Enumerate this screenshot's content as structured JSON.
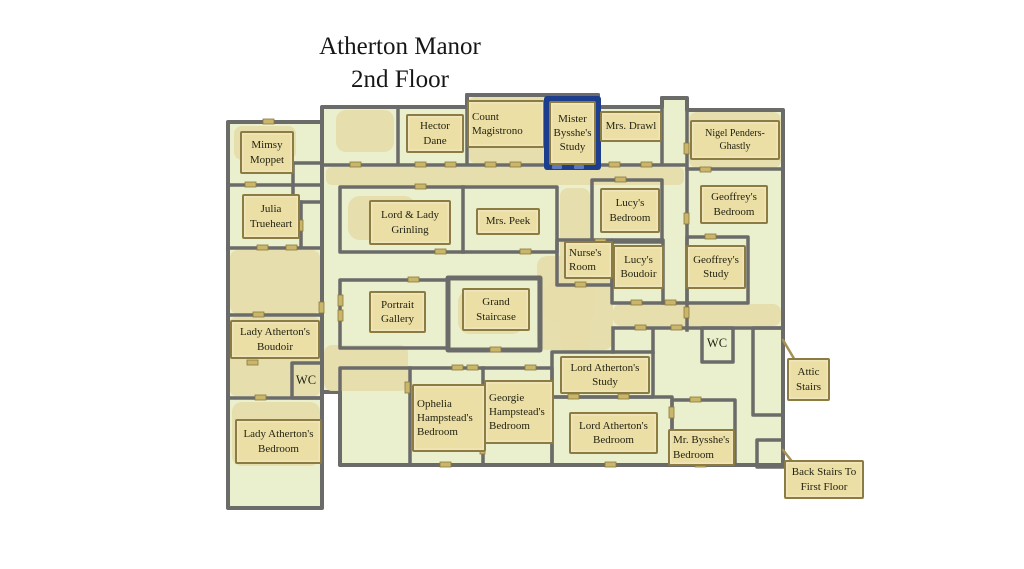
{
  "title": {
    "line1": "Atherton Manor",
    "line2": "2nd Floor"
  },
  "selected_room": "Mister Bysshe's Study",
  "colors": {
    "room_fill": "#eaf0cd",
    "corridor_fill": "#e6dcab",
    "wall": "#6b6b69",
    "label_fill": "#ecdfa6",
    "label_border": "#8d7c41",
    "label_text": "#232313",
    "highlight": "#1c3e8c",
    "background": "#ffffff"
  },
  "rooms": [
    {
      "id": "mimsy-moppet",
      "label": "Mimsy Moppet",
      "highlighted": false
    },
    {
      "id": "julia-trueheart",
      "label": "Julia Trueheart",
      "highlighted": false
    },
    {
      "id": "hector-dane",
      "label": "Hector Dane",
      "highlighted": false
    },
    {
      "id": "count-magistrono",
      "label": "Count Magistrono",
      "highlighted": false
    },
    {
      "id": "mister-bysshes-study",
      "label": "Mister Bysshe's Study",
      "highlighted": true
    },
    {
      "id": "mrs-drawl",
      "label": "Mrs. Drawl",
      "highlighted": false
    },
    {
      "id": "nigel-penders-ghastly",
      "label": "Nigel Penders-Ghastly",
      "highlighted": false
    },
    {
      "id": "lord-lady-grinling",
      "label": "Lord & Lady Grinling",
      "highlighted": false
    },
    {
      "id": "mrs-peek",
      "label": "Mrs. Peek",
      "highlighted": false
    },
    {
      "id": "lucys-bedroom",
      "label": "Lucy's Bedroom",
      "highlighted": false
    },
    {
      "id": "nurses-room",
      "label": "Nurse's Room",
      "highlighted": false
    },
    {
      "id": "lucys-boudoir",
      "label": "Lucy's Boudoir",
      "highlighted": false
    },
    {
      "id": "geoffreys-bedroom",
      "label": "Geoffrey's Bedroom",
      "highlighted": false
    },
    {
      "id": "geoffreys-study",
      "label": "Geoffrey's Study",
      "highlighted": false
    },
    {
      "id": "portrait-gallery",
      "label": "Portrait Gallery",
      "highlighted": false
    },
    {
      "id": "grand-staircase",
      "label": "Grand Staircase",
      "highlighted": false
    },
    {
      "id": "lady-athertons-boudoir",
      "label": "Lady Atherton's Boudoir",
      "highlighted": false
    },
    {
      "id": "wc-west",
      "label": "WC",
      "highlighted": false
    },
    {
      "id": "lady-athertons-bedroom",
      "label": "Lady Atherton's Bedroom",
      "highlighted": false
    },
    {
      "id": "ophelia-hampsteads-bedroom",
      "label": "Ophelia Hampstead's Bedroom",
      "highlighted": false
    },
    {
      "id": "georgie-hampsteads-bedroom",
      "label": "Georgie Hampstead's Bedroom",
      "highlighted": false
    },
    {
      "id": "lord-athertons-study",
      "label": "Lord Atherton's Study",
      "highlighted": false
    },
    {
      "id": "lord-athertons-bedroom",
      "label": "Lord Atherton's Bedroom",
      "highlighted": false
    },
    {
      "id": "mr-bysshes-bedroom",
      "label": "Mr. Bysshe's Bedroom",
      "highlighted": false
    },
    {
      "id": "wc-east",
      "label": "WC",
      "highlighted": false
    },
    {
      "id": "attic-stairs",
      "label": "Attic Stairs",
      "highlighted": false
    },
    {
      "id": "back-stairs",
      "label": "Back Stairs To First Floor",
      "highlighted": false
    }
  ]
}
